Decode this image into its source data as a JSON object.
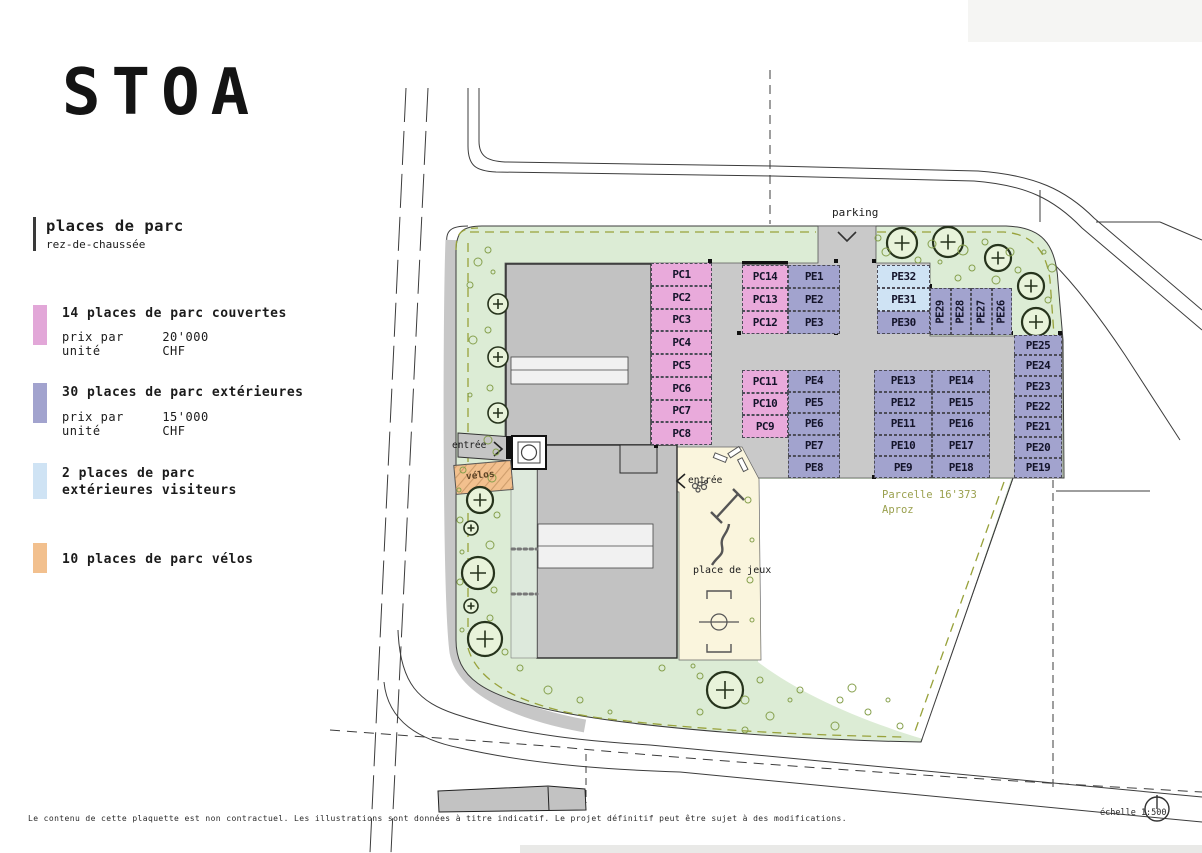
{
  "brand": {
    "logo": "STOA"
  },
  "legend": {
    "title": "places de parc",
    "subtitle": "rez-de-chaussée",
    "items": [
      {
        "swatch": "#e2a7d8",
        "label": "14 places de parc couvertes",
        "price_label": "prix par unité",
        "price": "20'000 CHF"
      },
      {
        "swatch": "#a2a3ce",
        "label": "30 places de parc extérieures",
        "price_label": "prix par unité",
        "price": "15'000 CHF"
      },
      {
        "swatch": "#cfe3f4",
        "label": "2 places de parc",
        "label2": "extérieures visiteurs"
      },
      {
        "swatch": "#f2c08e",
        "label": "10 places de parc vélos"
      }
    ]
  },
  "plan": {
    "parking_label": "parking",
    "entrance_left_label": "entrée",
    "entrance_mid_label": "entrée",
    "velos_label": "vélos",
    "playground_label": "place de jeux",
    "parcel_label_line1": "Parcelle 16'373",
    "parcel_label_line2": "Aproz",
    "covered_stalls": [
      "PC1",
      "PC2",
      "PC3",
      "PC4",
      "PC5",
      "PC6",
      "PC7",
      "PC8",
      "PC9",
      "PC10",
      "PC11",
      "PC12",
      "PC13",
      "PC14"
    ],
    "exterior_stalls": [
      "PE1",
      "PE2",
      "PE3",
      "PE4",
      "PE5",
      "PE6",
      "PE7",
      "PE8",
      "PE9",
      "PE10",
      "PE11",
      "PE12",
      "PE13",
      "PE14",
      "PE15",
      "PE16",
      "PE17",
      "PE18",
      "PE19",
      "PE20",
      "PE21",
      "PE22",
      "PE23",
      "PE24",
      "PE25",
      "PE26",
      "PE27",
      "PE28",
      "PE29",
      "PE30"
    ],
    "visitor_stalls": [
      "PE31",
      "PE32"
    ],
    "stall_colors": {
      "covered": "#e9aadb",
      "exterior": "#a2a3ce",
      "visitor": "#cfe3f4"
    }
  },
  "footer": {
    "disclaimer": "Le contenu de cette plaquette est non contractuel. Les illustrations sont données à titre indicatif. Le projet définitif peut être sujet à des modifications.",
    "scale_label": "échelle 1:500"
  }
}
